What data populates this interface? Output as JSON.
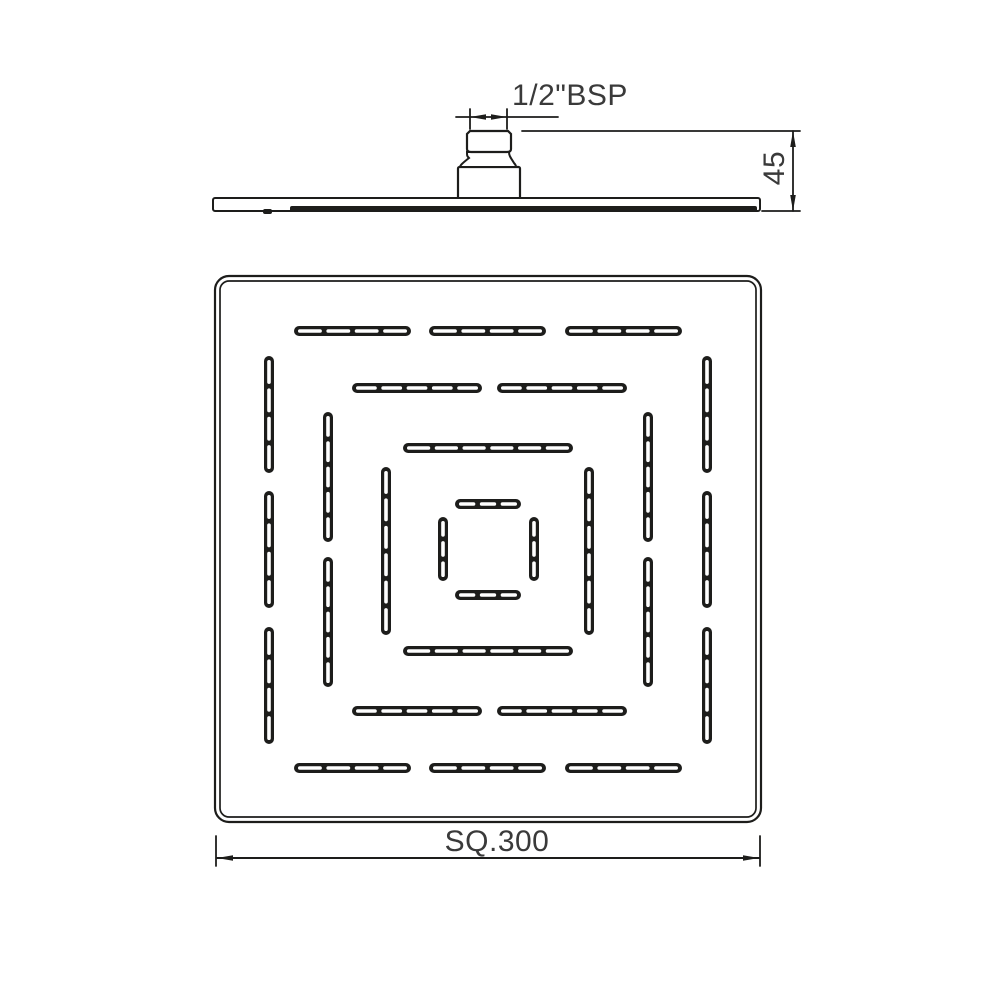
{
  "drawing": {
    "labels": {
      "thread": "1/2\"BSP",
      "height": "45",
      "size": "SQ.300"
    },
    "colors": {
      "line": "#1d1d1b",
      "text": "#3a3a3a",
      "background": "#ffffff"
    },
    "side_view": {
      "plate": {
        "x": 213,
        "y": 198,
        "w": 547,
        "h": 13
      },
      "face_band": {
        "x": 290,
        "y": 206,
        "w": 467,
        "h": 6
      },
      "notch": {
        "x": 263,
        "y": 209,
        "w": 9,
        "h": 5
      },
      "base": {
        "x": 458,
        "y": 167,
        "w": 62,
        "h": 32
      },
      "collar": {
        "top_l": 467,
        "top_r": 509,
        "bot_l": 460,
        "bot_r": 516,
        "top_y": 152,
        "bot_y": 167
      },
      "thread": {
        "x": 467,
        "y": 131,
        "w": 44,
        "h": 21
      },
      "dim_thread": {
        "wl": 470,
        "wr": 507,
        "line_y": 117,
        "wit_top": 109,
        "wit_bot": 129,
        "tail_x": 558
      },
      "dim_height": {
        "x": 793,
        "top_y": 131,
        "bot_y": 211,
        "wit_top_x1": 522,
        "wit_bot_x1": 762,
        "wit_x2": 800
      },
      "label_pos": {
        "thread": {
          "x": 570,
          "y": 96
        },
        "height": {
          "x": 775,
          "y": 168
        }
      }
    },
    "face_view": {
      "outer": {
        "x": 215,
        "y": 276,
        "w": 546,
        "h": 546,
        "r": 14
      },
      "inner_offset": 5,
      "strip_w": 10,
      "slot": {
        "w": 3.6,
        "end_pad": 4,
        "gap": 4.5
      },
      "rings": [
        {
          "name": "ring-1",
          "top_y": 331,
          "bottom_y": 768,
          "left_x": 269,
          "right_x": 707,
          "h_segments": [
            [
              294,
              411
            ],
            [
              429,
              546
            ],
            [
              565,
              682
            ]
          ],
          "v_segments": [
            [
              356,
              473
            ],
            [
              491,
              608
            ],
            [
              627,
              744
            ]
          ],
          "slots_per_segment": 4
        },
        {
          "name": "ring-2",
          "top_y": 388,
          "bottom_y": 711,
          "left_x": 328,
          "right_x": 648,
          "h_segments": [
            [
              352,
              482
            ],
            [
              497,
              627
            ]
          ],
          "v_segments": [
            [
              412,
              542
            ],
            [
              557,
              687
            ]
          ],
          "slots_per_segment": 5
        },
        {
          "name": "ring-3",
          "top_y": 448,
          "bottom_y": 651,
          "left_x": 386,
          "right_x": 589,
          "h_segments": [
            [
              403,
              573
            ]
          ],
          "v_segments": [
            [
              467,
              635
            ]
          ],
          "slots_per_segment": 6
        },
        {
          "name": "ring-4",
          "top_y": 504,
          "bottom_y": 595,
          "left_x": 443,
          "right_x": 534,
          "h_segments": [
            [
              455,
              521
            ]
          ],
          "v_segments": [
            [
              517,
              581
            ]
          ],
          "slots_per_segment": 3
        }
      ],
      "dim_size": {
        "y": 858,
        "x1": 217,
        "x2": 759,
        "wit_y1": 836,
        "wit_y2": 866,
        "label_pos": {
          "x": 497,
          "y": 842
        }
      }
    }
  }
}
